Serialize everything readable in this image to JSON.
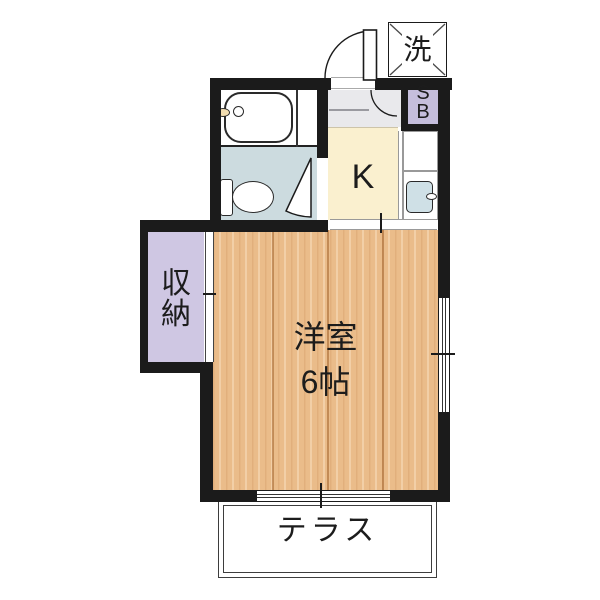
{
  "plan": {
    "laundry": {
      "label": "洗"
    },
    "shoe_box": {
      "line1": "S",
      "line2": "B"
    },
    "kitchen": {
      "label": "K"
    },
    "closet": {
      "char1": "収",
      "char2": "納"
    },
    "main_room": {
      "name": "洋室",
      "size": "6帖"
    },
    "terrace": {
      "label": "テラス"
    }
  },
  "colors": {
    "wall": "#1b1b1b",
    "wood": "#eabc8a",
    "bath-floor": "#ccdbdf",
    "kitchen-floor": "#faf0cf",
    "genkan-floor": "#e9e9ec",
    "closet-fill": "#cfc7e3",
    "shoebox-fill": "#c5bedc",
    "fixture-blue": "#cfe0e6",
    "faucet-cream": "#f2ddb0"
  }
}
